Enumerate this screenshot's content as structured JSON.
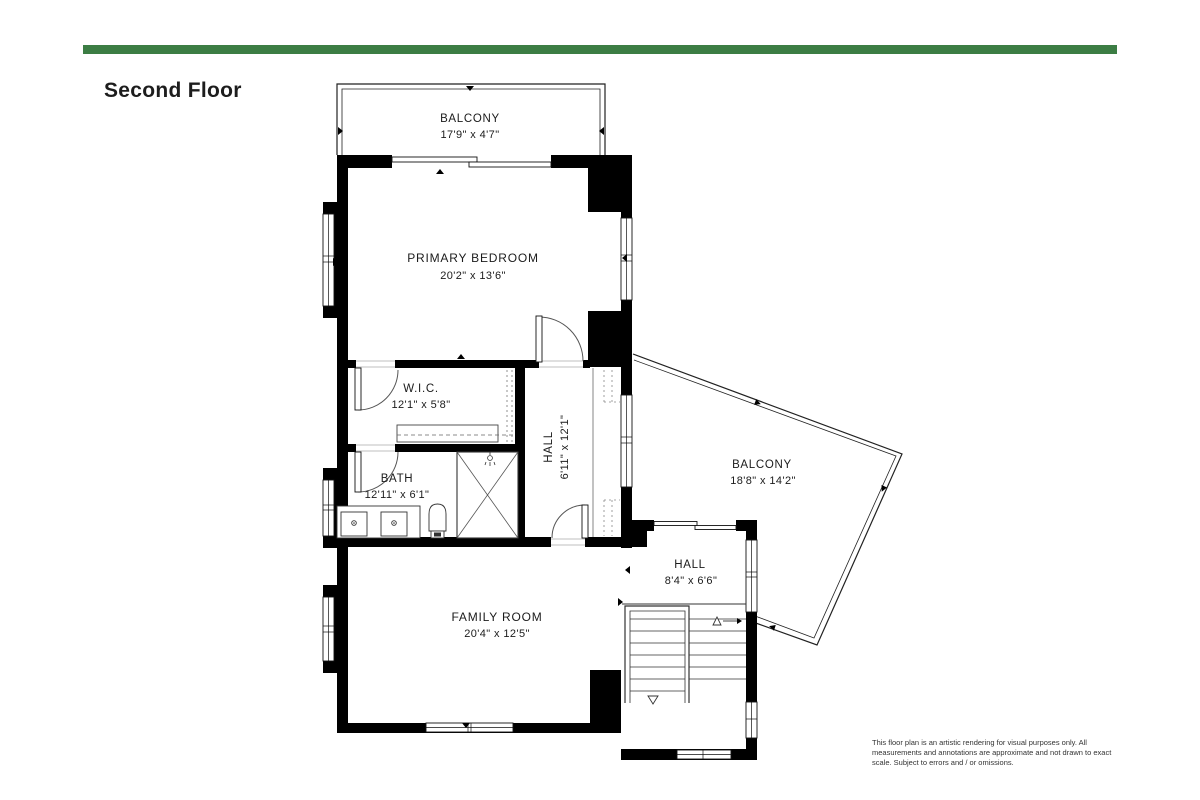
{
  "page": {
    "title": "Second Floor",
    "accent_bar_color": "#3C7D44",
    "wall_color": "#000000",
    "background_color": "#FFFFFF"
  },
  "rooms": {
    "balcony_top": {
      "name": "BALCONY",
      "dims": "17'9\" x 4'7\""
    },
    "primary_bedroom": {
      "name": "PRIMARY BEDROOM",
      "dims": "20'2\" x 13'6\""
    },
    "wic": {
      "name": "W.I.C.",
      "dims": "12'1\" x 5'8\""
    },
    "hall_upper": {
      "name": "HALL",
      "dims": "6'11\" x 12'1\""
    },
    "bath": {
      "name": "BATH",
      "dims": "12'11\" x 6'1\""
    },
    "balcony_right": {
      "name": "BALCONY",
      "dims": "18'8\" x 14'2\""
    },
    "hall_lower": {
      "name": "HALL",
      "dims": "8'4\" x 6'6\""
    },
    "family_room": {
      "name": "FAMILY ROOM",
      "dims": "20'4\" x 12'5\""
    }
  },
  "footer": {
    "disclaimer": "This floor plan is an artistic rendering for visual purposes only.  All measurements and annotations are approximate and not drawn to exact scale. Subject to errors and / or omissions."
  }
}
